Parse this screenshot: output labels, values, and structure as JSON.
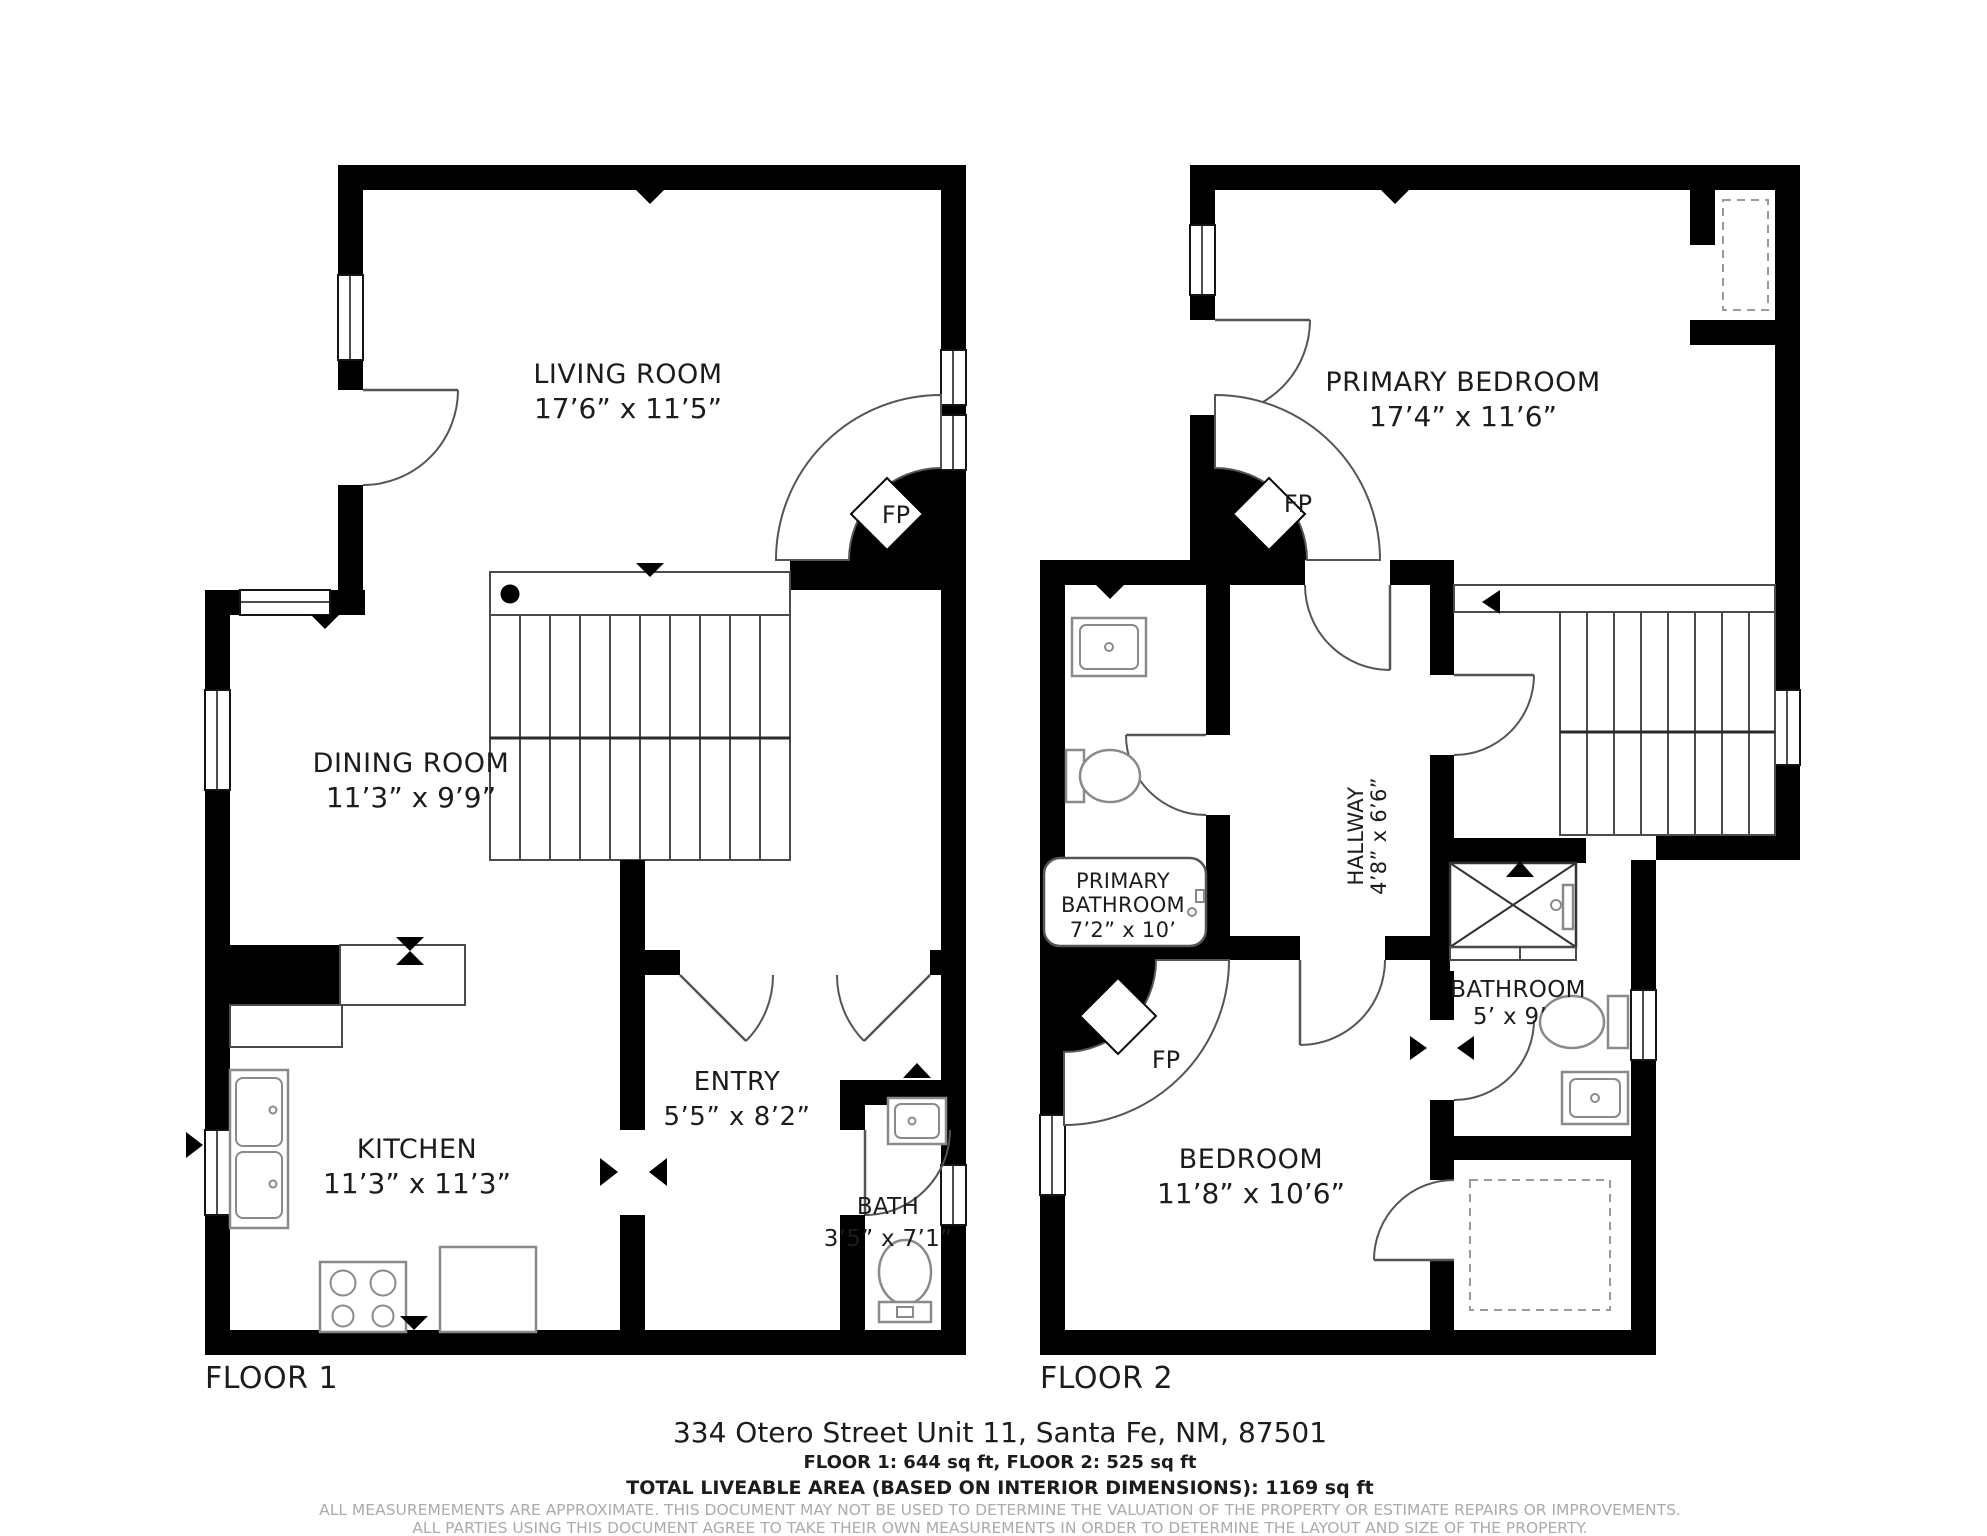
{
  "colors": {
    "wall": "#000000",
    "thin_line": "#4a4a4a",
    "fixture_line": "#8a8a8a",
    "text": "#1c1c1c",
    "muted_text": "#ababab",
    "background": "#ffffff"
  },
  "floor1": {
    "label": "FLOOR 1",
    "living_room": {
      "name": "LIVING ROOM",
      "dims": "17’6” x 11’5”"
    },
    "dining_room": {
      "name": "DINING ROOM",
      "dims": "11’3” x 9’9”"
    },
    "kitchen": {
      "name": "KITCHEN",
      "dims": "11’3” x 11’3”"
    },
    "entry": {
      "name": "ENTRY",
      "dims": "5’5” x 8’2”"
    },
    "bath": {
      "name": "BATH",
      "dims": "3’5” x 7’1”"
    },
    "fireplace": "FP"
  },
  "floor2": {
    "label": "FLOOR 2",
    "primary_bedroom": {
      "name": "PRIMARY BEDROOM",
      "dims": "17’4” x 11’6”"
    },
    "primary_bathroom": {
      "name_line1": "PRIMARY",
      "name_line2": "BATHROOM",
      "dims": "7’2” x 10’"
    },
    "hallway": {
      "name": "HALLWAY",
      "dims": "4’8” x 6’6”"
    },
    "bathroom": {
      "name": "BATHROOM",
      "dims": "5’ x 9’"
    },
    "bedroom": {
      "name": "BEDROOM",
      "dims": "11’8” x 10’6”"
    },
    "fireplace_primary": "FP",
    "fireplace_bedroom": "FP"
  },
  "footer": {
    "address": "334 Otero Street Unit 11, Santa Fe, NM, 87501",
    "floor_areas": "FLOOR 1: 644 sq ft, FLOOR 2: 525 sq ft",
    "total_area": "TOTAL LIVEABLE AREA (BASED ON INTERIOR DIMENSIONS): 1169 sq ft",
    "disclaimer_line1": "ALL MEASUREMEMENTS ARE APPROXIMATE. THIS DOCUMENT MAY NOT BE USED TO DETERMINE THE VALUATION OF THE PROPERTY OR ESTIMATE REPAIRS OR IMPROVEMENTS.",
    "disclaimer_line2": "ALL PARTIES USING THIS DOCUMENT AGREE TO TAKE THEIR OWN MEASUREMENTS IN ORDER TO DETERMINE THE LAYOUT AND SIZE OF THE PROPERTY."
  }
}
